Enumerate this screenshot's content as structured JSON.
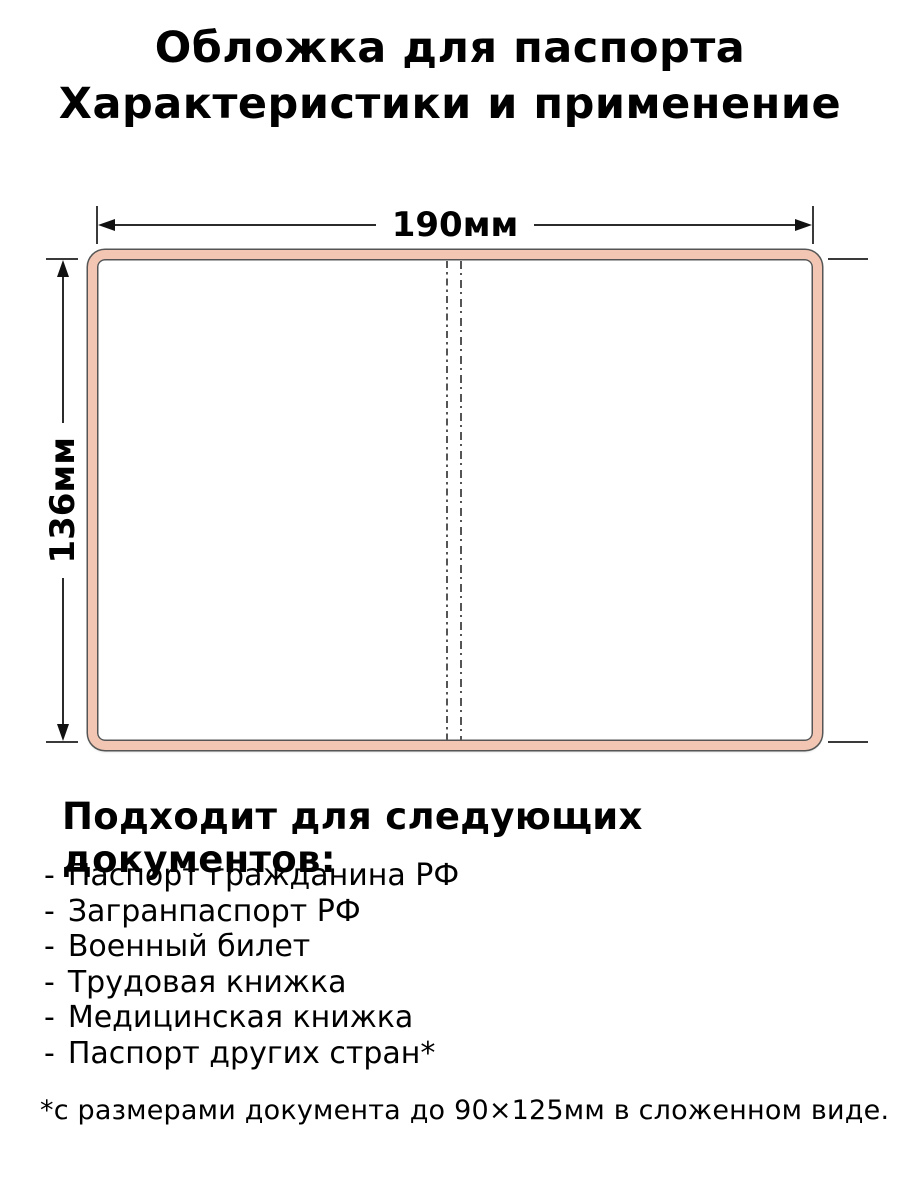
{
  "title": {
    "line1": "Обложка для паспорта",
    "line2": "Характеристики и применение"
  },
  "diagram": {
    "width_label": "190мм",
    "height_label": "136мм",
    "cover_color": "#f2c6b2",
    "outline_color": "#555555",
    "dimension_line_color": "#2b2b2b"
  },
  "section": {
    "heading": "Подходит для следующих документов:"
  },
  "list": {
    "bullet": "-",
    "items": [
      "Паспорт гражданина РФ",
      "Загранпаспорт РФ",
      "Военный билет",
      "Трудовая книжка",
      "Медицинская книжка",
      "Паспорт других стран*"
    ]
  },
  "footnote": "*с размерами документа до 90×125мм в сложенном виде."
}
